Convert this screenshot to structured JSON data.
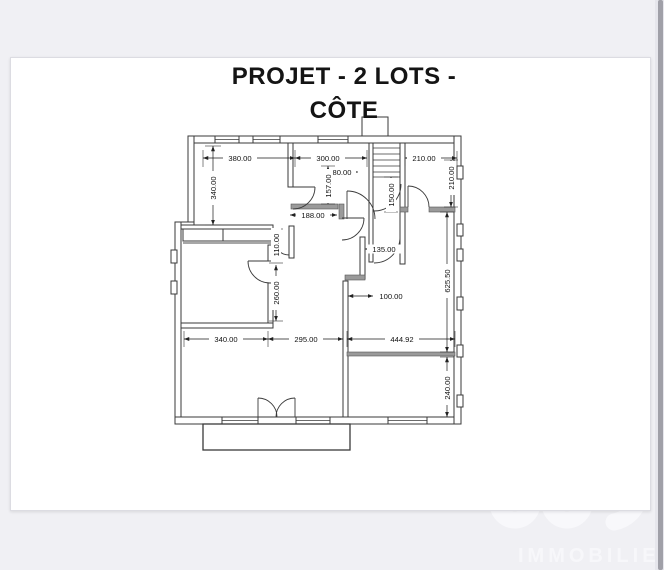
{
  "title": {
    "line1": "PROJET - 2 LOTS -",
    "line2": "CÔTE"
  },
  "plan": {
    "dimensions": {
      "top_left_width": "380.00",
      "top_middle_width": "300.00",
      "top_right_width": "210.00",
      "left_room_height": "340.00",
      "stair_opening_width": "80.00",
      "vestibule_height": "157.00",
      "stair_lobby_height": "150.00",
      "hall_width": "188.00",
      "top_right_height": "210.00",
      "closet_depth": "110.00",
      "middle_room_height": "260.00",
      "corridor_width": "135.00",
      "recess_width": "100.00",
      "right_wing_height": "625.50",
      "bottom_left_width": "340.00",
      "bottom_middle_width": "295.00",
      "bottom_right_width": "444.92",
      "bottom_right_height": "240.00"
    }
  },
  "watermark": {
    "brand": "IMMOBILIER"
  },
  "colors": {
    "page_background": "#f0f0f4",
    "card_background": "#ffffff",
    "plan_line": "#3a3a3a",
    "watermark": "#f7f7fa"
  }
}
